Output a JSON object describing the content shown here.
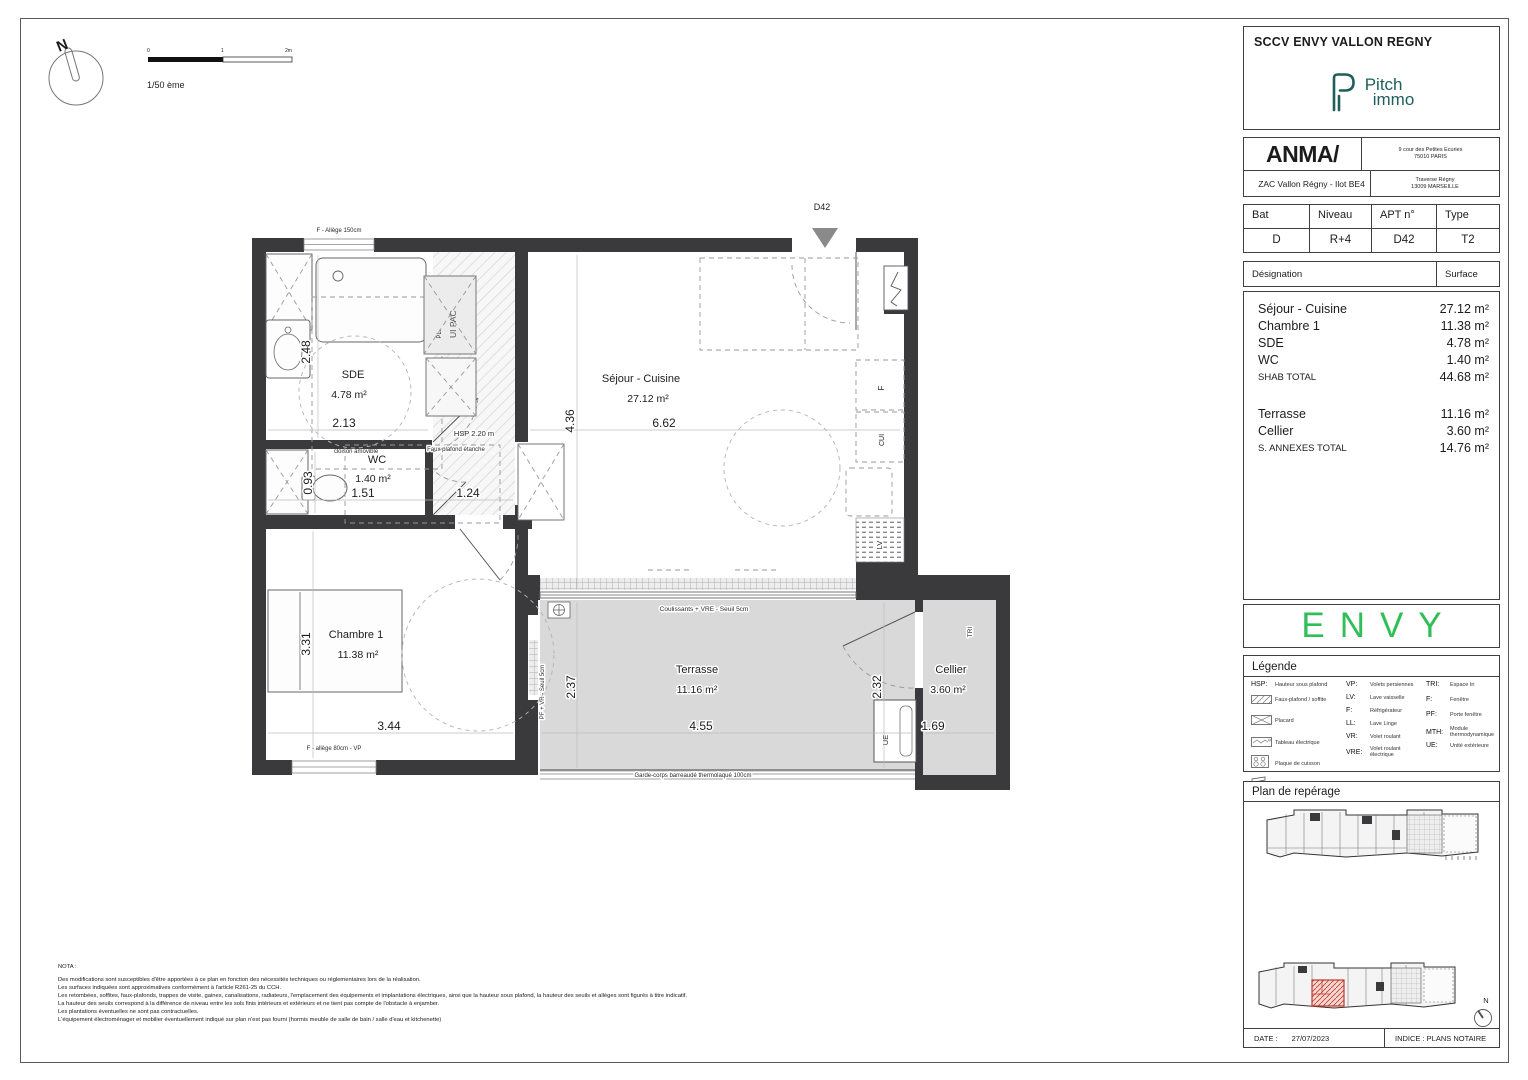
{
  "title_block": {
    "project": "SCCV ENVY VALLON REGNY",
    "brand_line1": "Pitch",
    "brand_line2": "immo",
    "architect": "ANMA/",
    "arch_address1": "9 cour des Petites Ecuries",
    "arch_address2": "75010 PARIS",
    "operation": "ZAC Vallon Régny - Ilot BE4",
    "site_address1": "Traverse Régny",
    "site_address2": "13009 MARSEILLE"
  },
  "unit": {
    "bat_label": "Bat",
    "bat": "D",
    "niveau_label": "Niveau",
    "niveau": "R+4",
    "apt_label": "APT n°",
    "apt": "D42",
    "type_label": "Type",
    "type": "T2"
  },
  "surfaces": {
    "designation_label": "Désignation",
    "surface_label": "Surface",
    "rows": [
      {
        "name": "Séjour - Cuisine",
        "value": "27.12 m²"
      },
      {
        "name": "Chambre 1",
        "value": "11.38 m²"
      },
      {
        "name": "SDE",
        "value": "4.78 m²"
      },
      {
        "name": "WC",
        "value": "1.40 m²"
      }
    ],
    "shab_label": "SHAB TOTAL",
    "shab_value": "44.68 m²",
    "annex_rows": [
      {
        "name": "Terrasse",
        "value": "11.16 m²"
      },
      {
        "name": "Cellier",
        "value": "3.60 m²"
      }
    ],
    "annex_label": "S. ANNEXES TOTAL",
    "annex_value": "14.76 m²"
  },
  "envy_logo": "ENVY",
  "legend": {
    "title": "Légende",
    "col1": [
      {
        "abbr": "HSP:",
        "label": "Hauteur sous plafond"
      },
      {
        "abbr": "",
        "label": "Faux-plafond / soffite"
      },
      {
        "abbr": "",
        "label": "Placard"
      },
      {
        "abbr": "",
        "label": "Tableau électrique"
      },
      {
        "abbr": "",
        "label": "Plaque de cuisson"
      },
      {
        "abbr": "",
        "label": "Gaine Technique"
      }
    ],
    "col2": [
      {
        "abbr": "VP:",
        "label": "Volets persiennes"
      },
      {
        "abbr": "LV:",
        "label": "Lave vaisselle"
      },
      {
        "abbr": "F:",
        "label": "Réfrigérateur"
      },
      {
        "abbr": "LL:",
        "label": "Lave Linge"
      },
      {
        "abbr": "VR:",
        "label": "Volet roulant"
      },
      {
        "abbr": "VRE:",
        "label": "Volet roulant électrique"
      }
    ],
    "col3": [
      {
        "abbr": "TRI:",
        "label": "Espace tri"
      },
      {
        "abbr": "F:",
        "label": "Fenêtre"
      },
      {
        "abbr": "PF:",
        "label": "Porte fenêtre"
      },
      {
        "abbr": "MTH:",
        "label": "Module thermodynamique"
      },
      {
        "abbr": "UE:",
        "label": "Unité extérieure"
      }
    ]
  },
  "reperage": {
    "title": "Plan de repérage",
    "north": "N"
  },
  "footer": {
    "date_label": "DATE :",
    "date": "27/07/2023",
    "indice": "INDICE : PLANS NOTAIRE"
  },
  "plan": {
    "scale": "1/50 ème",
    "tick0": "0",
    "tick1": "1",
    "tick2": "2m",
    "north": "N",
    "entry": "D42",
    "rooms": {
      "sde": {
        "name": "SDE",
        "area": "4.78 m²",
        "w": "2.13",
        "h": "2.48"
      },
      "wc": {
        "name": "WC",
        "area": "1.40 m²",
        "w": "1.51",
        "h": "0.93",
        "hall": "1.24"
      },
      "sejour": {
        "name": "Séjour - Cuisine",
        "area": "27.12 m²",
        "w": "6.62",
        "h": "4.36"
      },
      "chambre": {
        "name": "Chambre 1",
        "area": "11.38 m²",
        "w": "3.44",
        "h": "3.31"
      },
      "terrasse": {
        "name": "Terrasse",
        "area": "11.16 m²",
        "w": "4.55",
        "h": "2.37"
      },
      "cellier": {
        "name": "Cellier",
        "area": "3.60 m²",
        "w": "1.69",
        "h": "2.32"
      }
    },
    "notes": {
      "window_top": "F - Allège 150cm",
      "window_chambre": "F - allège 80cm - VP",
      "hsp": "HSP 2.20 m",
      "faux_plafond": "Faux plafond étanche",
      "cloison": "cloison amovible",
      "coulissants": "Coulissants + VRE - Seuil 5cm",
      "pf_vr": "PF + VR - Seuil 5cm",
      "garde_corps": "Garde-corps barreaudé thermolaqué 100cm",
      "pl": "PL.",
      "ui_pac": "UI PAC",
      "tri": "TRI",
      "ue": "UE",
      "f": "F",
      "cui": "CUI",
      "lv": "LV"
    }
  },
  "nota": {
    "title": "NOTA :",
    "lines": [
      "Des modifications sont susceptibles d'être apportées à ce plan en fonction des nécessités techniques ou réglementaires lors de la réalisation.",
      "Les surfaces indiquées sont approximatives conformément à l'article R261-25 du CCH.",
      "Les retombées, soffites, faux-plafonds, trappes de visite, gaines, canalisations, radiateurs, l'emplacement des équipements et implantations électriques, ainsi que la hauteur sous plafond, la hauteur des seuils et allèges sont figurés à titre indicatif.",
      "La hauteur des seuils correspond à la différence de niveau entre les sols finis intérieurs et extérieurs et ne tient pas compte de l'obstacle à enjamber.",
      "Les plantations éventuelles ne sont pas contractuelles.",
      "L'équipement électroménager et mobilier éventuellement indiqué sur plan n'est pas fourni (hormis meuble de salle de bain / salle d'eau et kitchenette)"
    ]
  },
  "colors": {
    "brand_teal": "#1E5F5B",
    "envy_green": "#2FBE57",
    "wall": "#3A3A3C",
    "unit_red": "#C0392B"
  }
}
